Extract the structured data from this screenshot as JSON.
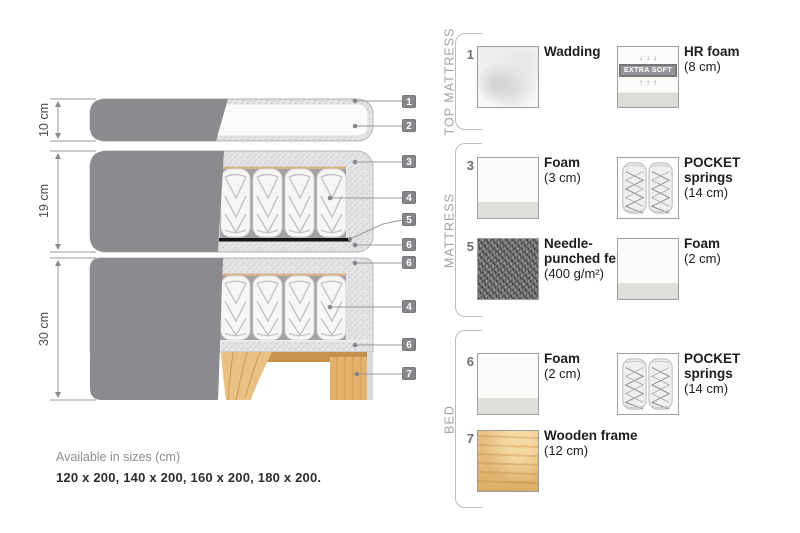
{
  "diagram": {
    "size_labels": {
      "top_mattress": "10 cm",
      "mattress": "19 cm",
      "bed": "30 cm"
    },
    "tags": {
      "t1": "1",
      "t2": "2",
      "t3": "3",
      "t4": "4",
      "t5": "5",
      "t6": "6",
      "t6b": "6",
      "t4b": "4",
      "t6c": "6",
      "t7": "7"
    }
  },
  "legend": {
    "sections": [
      {
        "title": "TOP MATTRESS",
        "items": [
          {
            "number": "1",
            "name": "Wadding",
            "detail": "",
            "swatch": "wadding"
          },
          {
            "number": "2",
            "name": "HR foam",
            "detail": "(8 cm)",
            "swatch": "hr-foam",
            "badge": "EXTRA SOFT",
            "arrows_down": "↓↓↓",
            "arrows_up": "↑↑↑"
          }
        ]
      },
      {
        "title": "MATTRESS",
        "items": [
          {
            "number": "3",
            "name": "Foam",
            "detail": "(3 cm)",
            "swatch": "foam"
          },
          {
            "number": "4",
            "name": "POCKET springs",
            "detail": "(14 cm)",
            "swatch": "pocket-springs"
          },
          {
            "number": "5",
            "name": "Needle-punched felt",
            "detail": "(400 g/m²)",
            "swatch": "felt"
          },
          {
            "number": "6",
            "name": "Foam",
            "detail": "(2 cm)",
            "swatch": "foam"
          }
        ]
      },
      {
        "title": "BED",
        "items": [
          {
            "number": "6",
            "name": "Foam",
            "detail": "(2 cm)",
            "swatch": "foam"
          },
          {
            "number": "4",
            "name": "POCKET springs",
            "detail": "(14 cm)",
            "swatch": "pocket-springs"
          },
          {
            "number": "7",
            "name": "Wooden frame",
            "detail": "(12 cm)",
            "swatch": "wood"
          }
        ]
      }
    ]
  },
  "footer": {
    "availability": "Available in sizes (cm)",
    "sizes": "120 x 200, 140 x 200, 160 x 200, 180 x 200."
  },
  "colors": {
    "cover_gray": "#8b8b8f",
    "foam_speckle": "#e3e3e5",
    "springs_backdrop": "#a2a2a5",
    "wood": "#e3b36b",
    "tag_bg": "#87878b",
    "felt_dark": "#141414",
    "tan_line": "#d7b289",
    "muted_text": "#a2a2a2"
  }
}
